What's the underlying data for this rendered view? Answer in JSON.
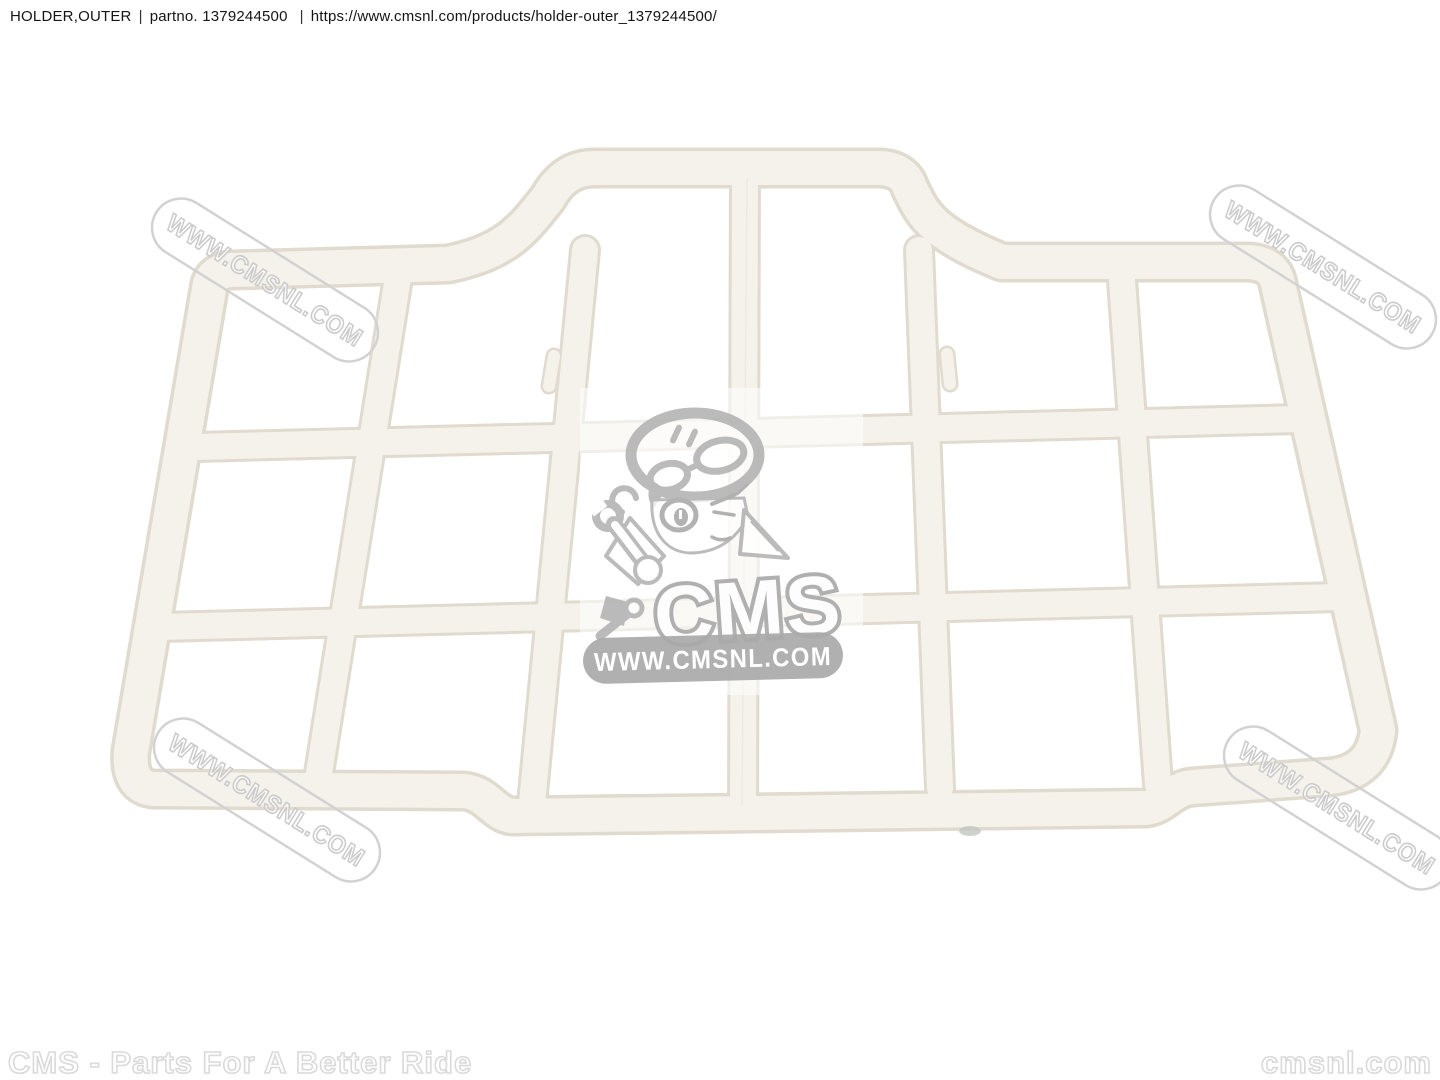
{
  "header": {
    "title": "HOLDER,OUTER",
    "separator": "|",
    "partno_label": "partno.",
    "partno_value": "1379244500",
    "url": "https://www.cmsnl.com/products/holder-outer_1379244500/"
  },
  "product_image": {
    "description": "White plastic outer holder grid panel, 6x3 cell lattice with raised two-cell top section",
    "part_fill_color": "#f5f2ec",
    "part_edge_color": "#e0dbce"
  },
  "watermark": {
    "text": "WWW.CMSNL.COM",
    "color": "#d0d0d0"
  },
  "logo": {
    "cms_text": "CMS",
    "banner_text": "WWW.CMSNL.COM",
    "banner_color": "#a9a9a9",
    "mascot": "cms-mascot-mechanic-girl-with-wrench"
  },
  "footer": {
    "tagline": "CMS - Parts For A Better Ride",
    "site": "cmsnl.com"
  }
}
